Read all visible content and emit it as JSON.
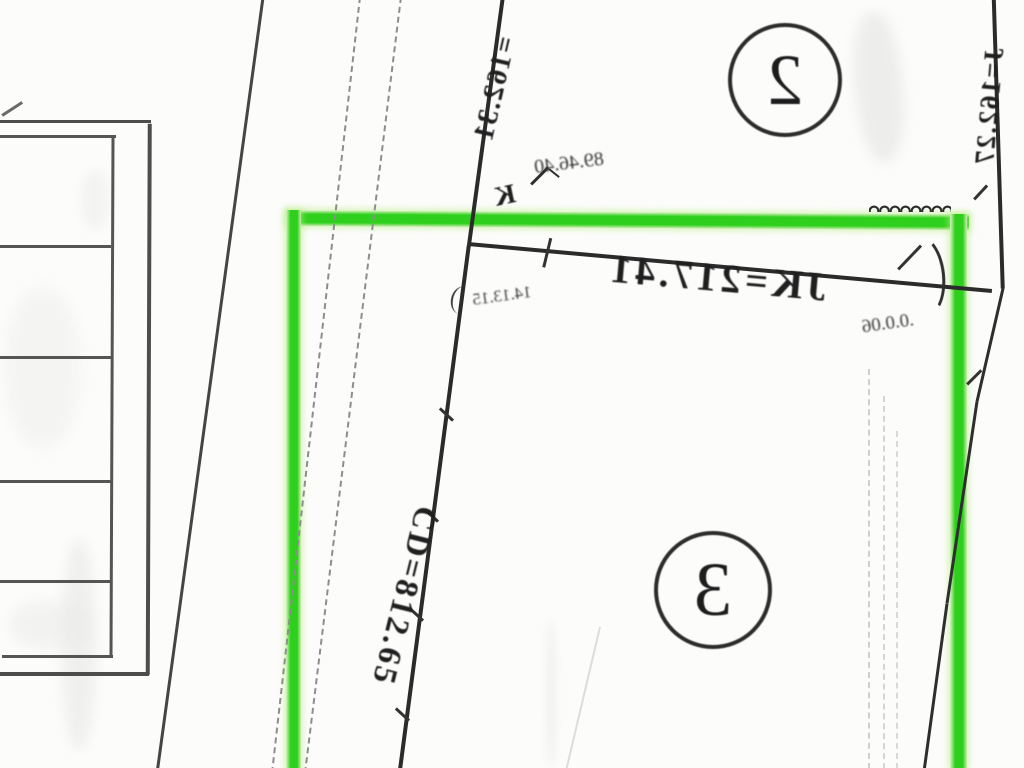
{
  "document": {
    "kind": "cadastral plat map detail (mirrored scan)",
    "background_color": "#fcfcfb",
    "line_color": "#2b2b2b"
  },
  "highlight": {
    "color": "#2fd01d",
    "shape": "rectangle outline",
    "role": "selected parcel boundary around parcel 3"
  },
  "labels": {
    "parcel2": "2",
    "parcel3": "3",
    "dimJ": "J=162.27",
    "dim162": "=162.31",
    "dimJK": "JK=217.41",
    "dimCD": "CD=812.65",
    "angle1": "89.46.40",
    "angle2": "14.13.15",
    "angle3": ".0.0.06",
    "pointK": "K"
  }
}
